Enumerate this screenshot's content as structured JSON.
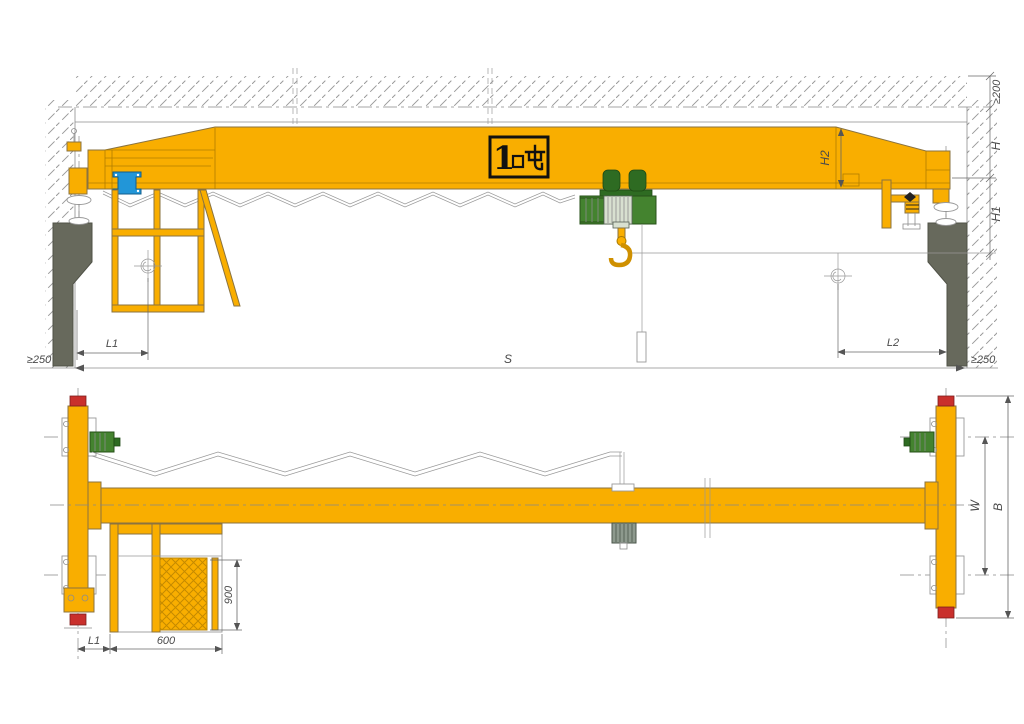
{
  "capacity": {
    "number": "1",
    "label": "1吨"
  },
  "top_view": {
    "clearance_top": "≥200",
    "height_h": "H",
    "height_h1": "H1",
    "girder_depth_h2": "H2",
    "hook_left_approach": "L1",
    "hook_right_approach": "L2",
    "span": "S",
    "wall_clearance_left": "≥250",
    "wall_clearance_right": "≥250"
  },
  "bottom_view": {
    "end_approach": "L1",
    "platform_length": "600",
    "platform_depth": "900",
    "wheel_base": "W",
    "end_carriage_length": "B"
  },
  "colors": {
    "girder_yellow": "#F9AE00",
    "hoist_green": "#44832F",
    "buffer_red": "#C9302C",
    "column_gray": "#67695C",
    "electrical_box_blue": "#2296D8"
  }
}
